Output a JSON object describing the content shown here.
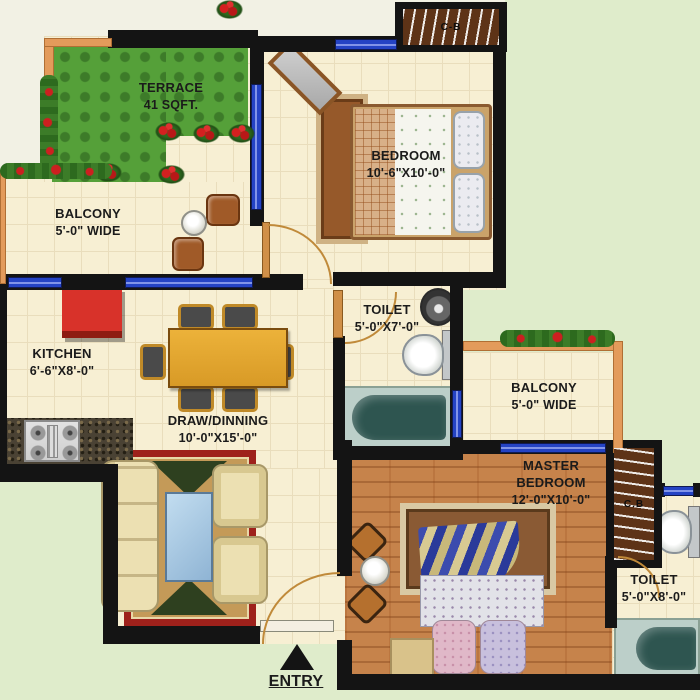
{
  "colors": {
    "outside_green": "#dfeccb",
    "floor_cream": "#f7efd3",
    "wall_black": "#141414",
    "window_blue": "#2443c4",
    "parapet_orange": "#e39b5b",
    "grass_green": "#55a039",
    "wood_floor_brown": "#c6834b",
    "fridge_red": "#d8322a",
    "rug_red": "#9e211b"
  },
  "rooms": {
    "terrace": {
      "name": "TERRACE",
      "dim": "41 SQFT."
    },
    "balcony_left": {
      "name": "BALCONY",
      "dim": "5'-0\" WIDE"
    },
    "bedroom": {
      "name": "BEDROOM",
      "dim": "10'-6\"X10'-0\""
    },
    "toilet_top": {
      "name": "TOILET",
      "dim": "5'-0\"X7'-0\""
    },
    "kitchen": {
      "name": "KITCHEN",
      "dim": "6'-6\"X8'-0\""
    },
    "draw_dining": {
      "name": "DRAW/DINNING",
      "dim": "10'-0\"X15'-0\""
    },
    "balcony_right": {
      "name": "BALCONY",
      "dim": "5'-0\" WIDE"
    },
    "master_bedroom": {
      "name": "MASTER BEDROOM",
      "dim": "12'-0\"X10'-0\""
    },
    "toilet_master": {
      "name": "TOILET",
      "dim": "5'-0\"X8'-0\""
    }
  },
  "markers": {
    "entry": "ENTRY",
    "cupboard_bedroom": "C-B",
    "cupboard_master": "C.B"
  }
}
